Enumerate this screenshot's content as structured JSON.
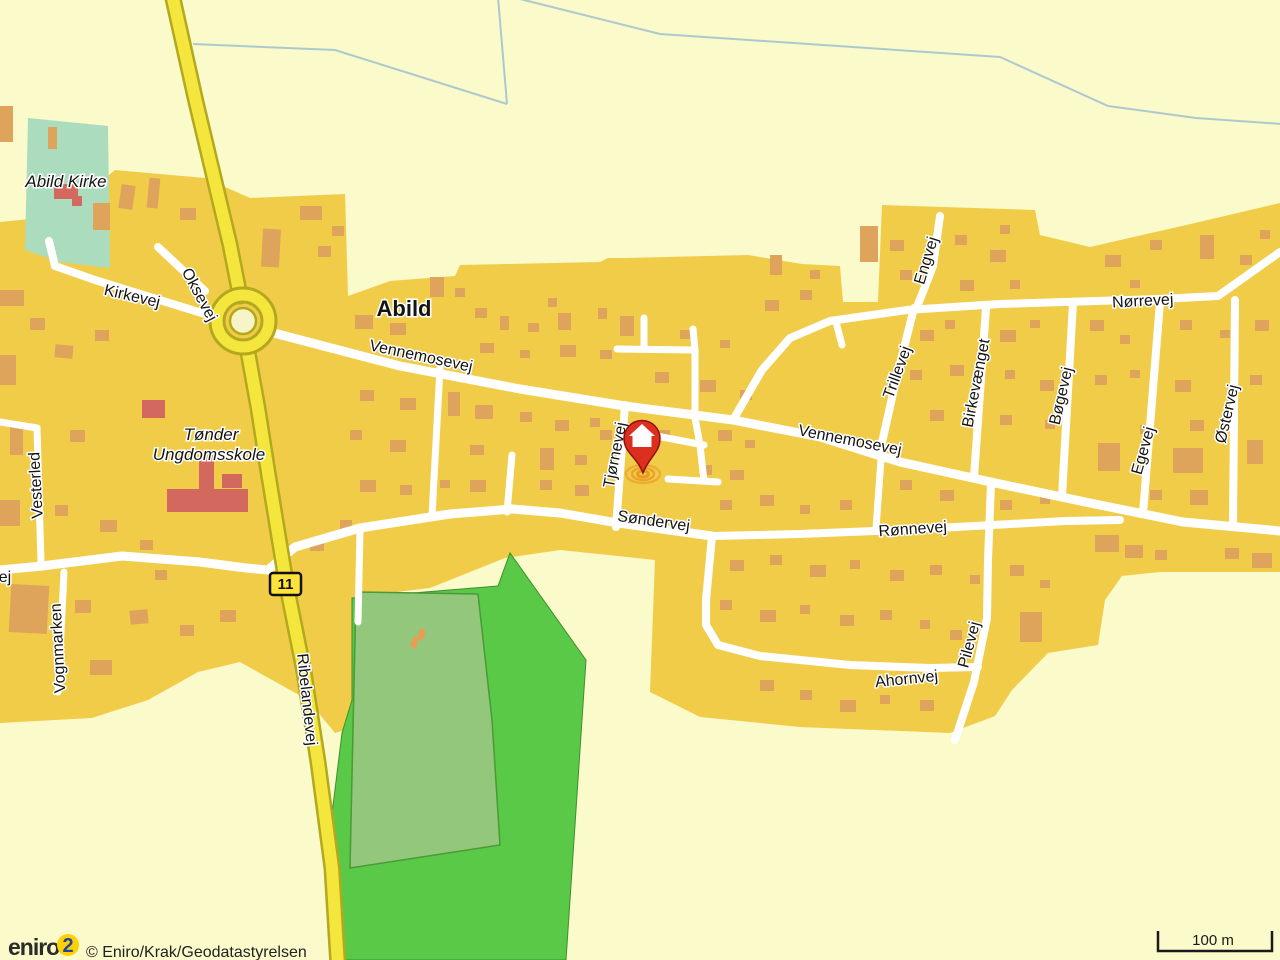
{
  "map": {
    "places": {
      "town": "Abild",
      "church": "Abild Kirke",
      "school_line1": "Tønder",
      "school_line2": "Ungdomsskole"
    },
    "streets": {
      "kirkevej": "Kirkevej",
      "oksevej": "Oksevej",
      "vennemosevej_west": "Vennemosevej",
      "vennemosevej_east": "Vennemosevej",
      "tjornevej": "Tjørnevej",
      "sondervej": "Søndervej",
      "ronnevej": "Rønnevej",
      "ahornvej": "Ahornvej",
      "pilevej": "Pilevej",
      "engvej": "Engvej",
      "trillevej": "Trillevej",
      "birkevaenget": "Birkevænget",
      "bogevej": "Bøgevej",
      "egevej": "Egevej",
      "ostervej": "Østervej",
      "norrevej": "Nørrevej",
      "vesterled": "Vesterled",
      "vognmarken": "Vognmarken",
      "ribelandevej": "Ribelandevej",
      "partial_west": "ej"
    },
    "route_badge": "11",
    "scale_bar": {
      "label": "100 m"
    },
    "attribution": {
      "logo_text": "eniro",
      "logo_mark": "2",
      "copyright": "© Eniro/Krak/Geodatastyrelsen"
    },
    "colors": {
      "background": "#FAFACB",
      "urban": "#F1CC49",
      "building": "#DFA45B",
      "building_red": "#D2685E",
      "field_green": "#59C947",
      "field_light": "#93C77B",
      "church_green": "#ACDCBE",
      "road_white": "#FFFFFF",
      "main_road": "#F4E63C",
      "main_road_casing": "#B3A81E",
      "stream": "#AEC9CE",
      "pin_red": "#DD2F1F",
      "ripple_orange": "#E8951F",
      "badge_yellow": "#FFE33A",
      "logo_yellow": "#FFD103",
      "logo_blue": "#23469B"
    }
  }
}
